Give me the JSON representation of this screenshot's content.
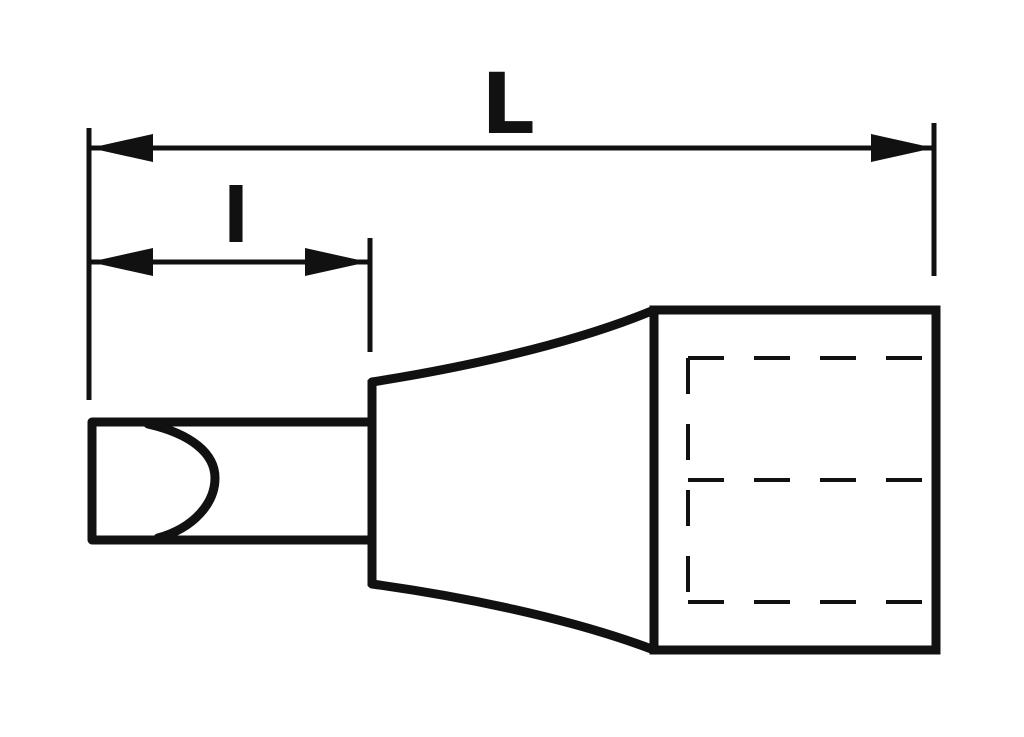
{
  "diagram": {
    "subject": "screwdriver-bit-socket-side-view",
    "view": "technical-line-drawing",
    "background_color": "#ffffff",
    "line_color": "#111111",
    "dimensions": {
      "overall_length": {
        "label": "L"
      },
      "bit_length": {
        "label": "l"
      }
    }
  }
}
